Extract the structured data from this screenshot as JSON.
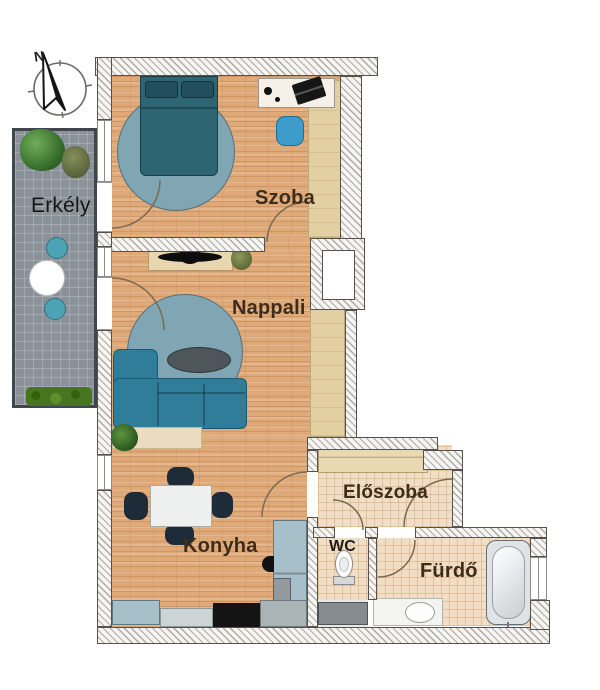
{
  "plan": {
    "compass_label": "N",
    "rooms": {
      "balcony": "Erkély",
      "bedroom": "Szoba",
      "living_room": "Nappali",
      "kitchen": "Konyha",
      "hallway": "Előszoba",
      "toilet": "WC",
      "bathroom": "Fürdő"
    },
    "palette": {
      "wall_line": "#55524c",
      "wood_floor": "#dfa978",
      "tile_floor": "#f0dec6",
      "balcony_floor": "#8a9199",
      "sofa_teal": "#2f7d99",
      "rug_blue": "#7fa6b2",
      "bed_teal": "#2d6573",
      "desk_chair_blue": "#3e9ccb",
      "counter_blue_gray": "#a7bfc8",
      "cabinet_beige": "#e7d6ae",
      "appliance_black": "#151515",
      "label_brown": "#3e2c1a"
    }
  }
}
